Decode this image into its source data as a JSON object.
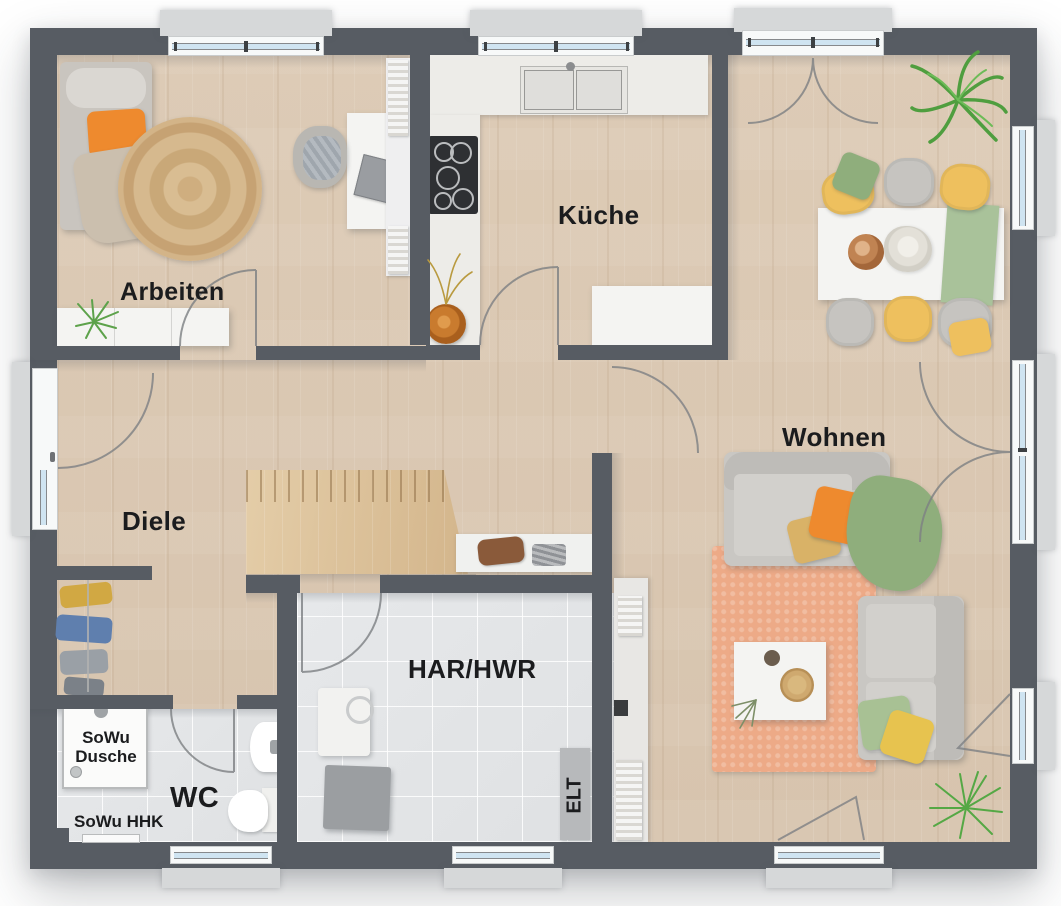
{
  "title": "Erdgeschoss Grundriss",
  "rooms": {
    "arbeiten": {
      "label": "Arbeiten"
    },
    "kueche": {
      "label": "Küche"
    },
    "wohnen": {
      "label": "Wohnen"
    },
    "diele": {
      "label": "Diele"
    },
    "wc": {
      "label": "WC"
    },
    "har": {
      "label": "HAR/HWR"
    }
  },
  "panels": {
    "elt_label": "ELT"
  },
  "fixtures": {
    "shower_label_line1": "SoWu",
    "shower_label_line2": "Dusche",
    "radiator_label": "SoWu HHK"
  },
  "colors": {
    "wall": "#575c63",
    "wood_floor": "#dbc9b4",
    "tile_floor": "#e3e5e7",
    "window_glass": "#cfe4f1",
    "accent_orange": "#ee8a2e",
    "rug_orange": "#edaa87",
    "jute_rug": "#d3b488",
    "chair_yellow": "#eec05e",
    "accent_green": "#8fae7c",
    "sofa_gray": "#c9c7c3",
    "counter_white": "#f4f4f2"
  }
}
